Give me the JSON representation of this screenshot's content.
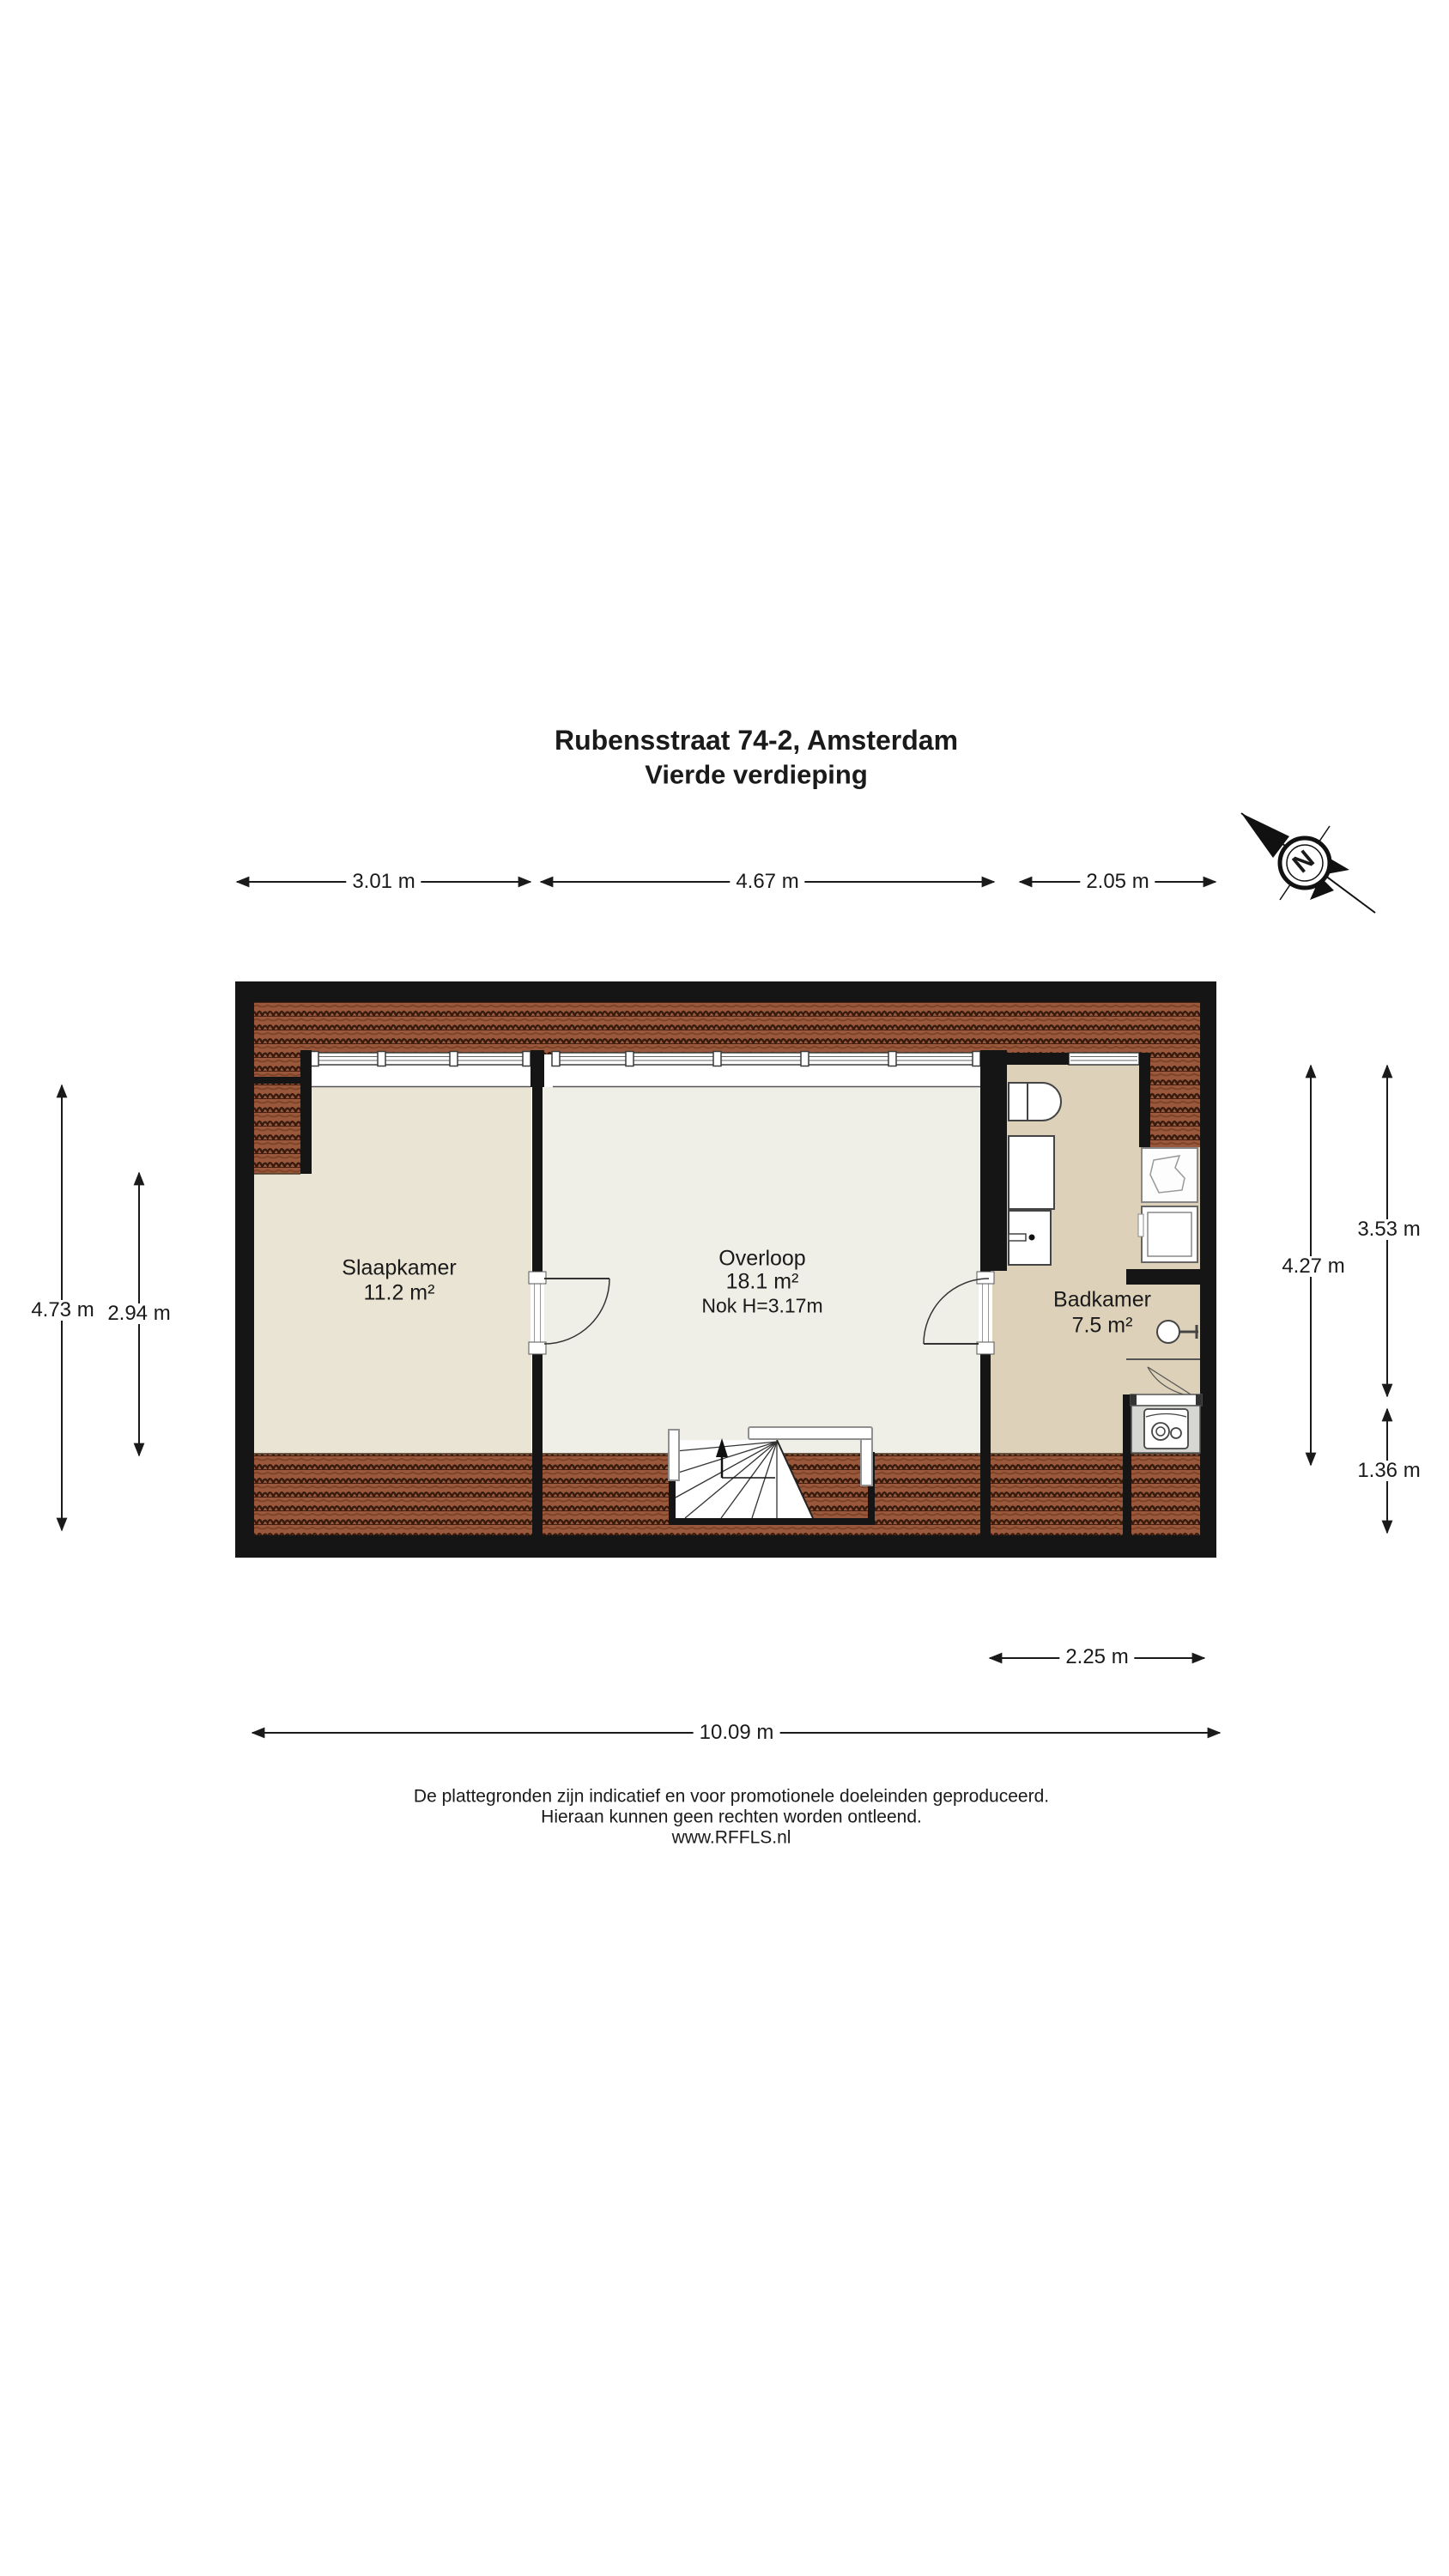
{
  "title": {
    "line1": "Rubensstraat 74-2, Amsterdam",
    "line2": "Vierde verdieping"
  },
  "compass": {
    "north_label": "N"
  },
  "rooms": {
    "slaapkamer": {
      "name": "Slaapkamer",
      "area": "11.2 m²"
    },
    "overloop": {
      "name": "Overloop",
      "area": "18.1 m²",
      "ridge_note": "Nok H=3.17m"
    },
    "badkamer": {
      "name": "Badkamer",
      "area": "7.5 m²"
    }
  },
  "dimensions": {
    "top": {
      "d1": "3.01 m",
      "d2": "4.67 m",
      "d3": "2.05 m"
    },
    "left": {
      "d1": "4.73 m",
      "d2": "2.94 m"
    },
    "right": {
      "d1": "4.27 m",
      "d2": "3.53 m",
      "d3": "1.36 m"
    },
    "bottom": {
      "d1": "2.25 m",
      "d2": "10.09 m"
    }
  },
  "disclaimer": {
    "line1": "De plattegronden zijn indicatief en voor promotionele doeleinden geproduceerd.",
    "line2": "Hieraan kunnen geen rechten worden ontleend.",
    "line3": "www.RFFLS.nl"
  },
  "colors": {
    "wall": "#151515",
    "roof_tile": "#99583b",
    "roof_tile_dark": "#381b0d",
    "floor_slaapkamer": "#eae4d4",
    "floor_overloop": "#efeee7",
    "floor_badkamer": "#ddd2b9",
    "closet_grey": "#d6d6d3"
  }
}
